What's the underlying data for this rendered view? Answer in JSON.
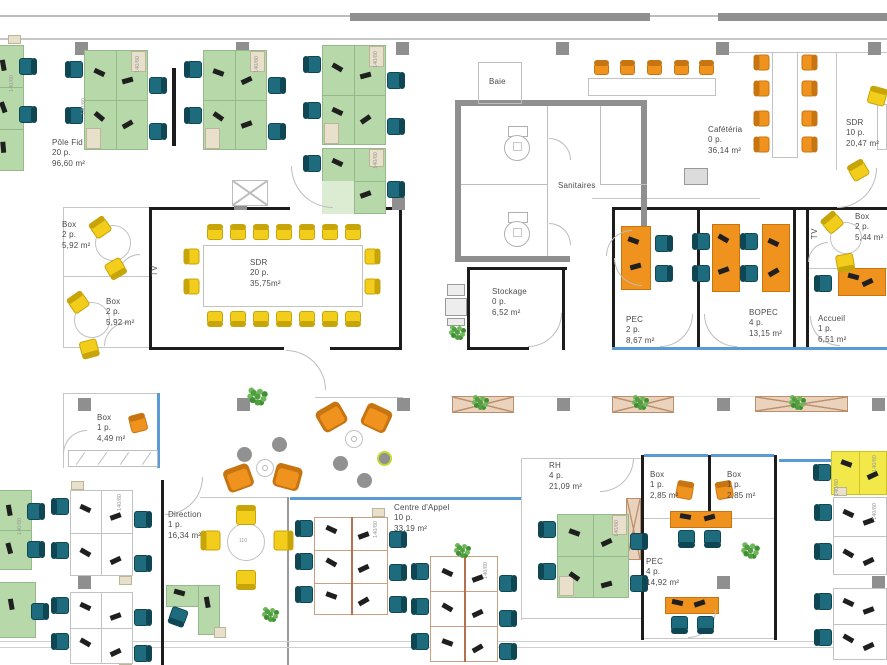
{
  "plan": {
    "width": 887,
    "height": 665
  },
  "rooms": [
    {
      "id": "pole-fid",
      "name": "Pôle Fid",
      "cap": "20 p.",
      "area": "96,60 m²"
    },
    {
      "id": "box-left-1",
      "name": "Box",
      "cap": "2 p.",
      "area": "5,92 m²"
    },
    {
      "id": "box-left-2",
      "name": "Box",
      "cap": "2 p.",
      "area": "5,92 m²"
    },
    {
      "id": "sdr-main",
      "name": "SDR",
      "cap": "20 p.",
      "area": "35,75m²"
    },
    {
      "id": "baie",
      "name": "Baie",
      "cap": "",
      "area": ""
    },
    {
      "id": "sanitaires",
      "name": "Sanitaires",
      "cap": "",
      "area": ""
    },
    {
      "id": "cafeteria",
      "name": "Cafétéria",
      "cap": "0 p.",
      "area": "36,14 m²"
    },
    {
      "id": "sdr-right",
      "name": "SDR",
      "cap": "10 p.",
      "area": "20,47 m²"
    },
    {
      "id": "stockage",
      "name": "Stockage",
      "cap": "0 p.",
      "area": "6,52 m²"
    },
    {
      "id": "pec",
      "name": "PEC",
      "cap": "2 p.",
      "area": "8,67 m²"
    },
    {
      "id": "bopec",
      "name": "BOPEC",
      "cap": "4 p.",
      "area": "13,15 m²"
    },
    {
      "id": "accueil",
      "name": "Accueil",
      "cap": "1 p.",
      "area": "6,51 m²"
    },
    {
      "id": "box-right",
      "name": "Box",
      "cap": "2 p.",
      "area": "5,44 m²"
    },
    {
      "id": "box-mid",
      "name": "Box",
      "cap": "1 p.",
      "area": "4,49 m²"
    },
    {
      "id": "direction",
      "name": "Direction",
      "cap": "1 p.",
      "area": "16,34 m²"
    },
    {
      "id": "centre-appel",
      "name": "Centre d'Appel",
      "cap": "10 p.",
      "area": "33,19 m²"
    },
    {
      "id": "rh",
      "name": "RH",
      "cap": "4 p.",
      "area": "21,09 m²"
    },
    {
      "id": "box-b1",
      "name": "Box",
      "cap": "1 p.",
      "area": "2,85 m²"
    },
    {
      "id": "box-b2",
      "name": "Box",
      "cap": "1 p.",
      "area": "2,85 m²"
    },
    {
      "id": "pec-4",
      "name": "PEC",
      "cap": "4 p.",
      "area": "14,92 m²"
    }
  ],
  "labels": {
    "tv": "TV",
    "sanitaires": "Sanitaires",
    "baie": "Baie",
    "desk_size": "140/80",
    "table_size": "110"
  },
  "colors": {
    "desk_green": "#b7d9aa",
    "desk_green_border": "#94b98a",
    "desk_light": "#dcecd2",
    "desk_white": "#ffffff",
    "desk_white_border": "#c2c2c2",
    "desk_yellow": "#f2e84a",
    "desk_yellow_border": "#cfc321",
    "chair_teal": "#1d6b7c",
    "chair_teal_dark": "#0e4653",
    "chair_yellow": "#f2cd1c",
    "chair_yellow_dark": "#c7a509",
    "chair_orange": "#f0921e",
    "chair_orange_dark": "#c67511",
    "wall_black": "#1c1c1c",
    "wall_gray": "#8f8f8f",
    "wall_light": "#c6c6c6",
    "glass_blue": "#5b9bd5",
    "planter_tan": "#ead2bc",
    "planter_border": "#b98f6d",
    "brown_trim": "#b5714f",
    "ca_border": "#c8a184",
    "caisson": "#e8e0cb",
    "caisson_border": "#bdb59a",
    "plant_green": "#4f9e3f",
    "plant_green2": "#6fb85a",
    "plant_green3": "#3f8f34",
    "column_gray": "#8f8f8f",
    "pouf_gray": "#919191",
    "pouf_lime": "#c3d830",
    "item_black": "#1f1f1f",
    "text": "#4a4a4a"
  }
}
